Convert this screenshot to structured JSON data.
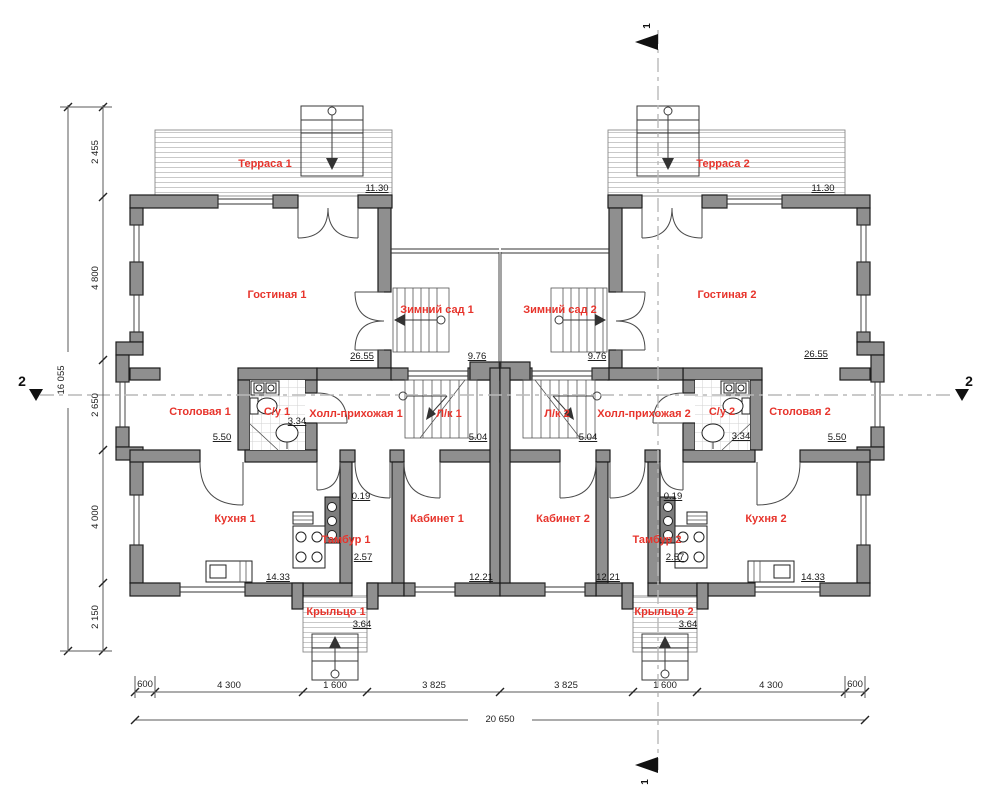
{
  "rooms": [
    {
      "id": "terrace-1",
      "label": "Терраса 1",
      "area": "11.30"
    },
    {
      "id": "terrace-2",
      "label": "Терраса 2",
      "area": "11.30"
    },
    {
      "id": "living-1",
      "label": "Гостиная 1",
      "area": "26.55"
    },
    {
      "id": "living-2",
      "label": "Гостиная 2",
      "area": "26.55"
    },
    {
      "id": "winter-garden-1",
      "label": "Зимний сад 1",
      "area": "9.76"
    },
    {
      "id": "winter-garden-2",
      "label": "Зимний сад 2",
      "area": "9.76"
    },
    {
      "id": "dining-1",
      "label": "Столовая 1",
      "area": "5.50"
    },
    {
      "id": "dining-2",
      "label": "Столовая 2",
      "area": "5.50"
    },
    {
      "id": "wc-1",
      "label": "С/у 1",
      "area": "3.34"
    },
    {
      "id": "wc-2",
      "label": "С/у 2",
      "area": "3.34"
    },
    {
      "id": "hall-1",
      "label": "Холл-прихожая 1"
    },
    {
      "id": "hall-2",
      "label": "Холл-прихожая 2"
    },
    {
      "id": "stair-1",
      "label": "Л/к 1",
      "area": "5.04"
    },
    {
      "id": "stair-2",
      "label": "Л/к 2",
      "area": "5.04"
    },
    {
      "id": "kitchen-1",
      "label": "Кухня 1",
      "area": "14.33"
    },
    {
      "id": "kitchen-2",
      "label": "Кухня 2",
      "area": "14.33"
    },
    {
      "id": "tambour-1",
      "label": "Тамбур 1",
      "area": "2.57"
    },
    {
      "id": "tambour-2",
      "label": "Тамбур 2",
      "area": "2.57"
    },
    {
      "id": "study-1",
      "label": "Кабинет 1",
      "area": "12.21"
    },
    {
      "id": "study-2",
      "label": "Кабинет 2",
      "area": "12.21"
    },
    {
      "id": "porch-1",
      "label": "Крыльцо 1",
      "area": "3.64"
    },
    {
      "id": "porch-2",
      "label": "Крыльцо 2",
      "area": "3.64"
    }
  ],
  "dimensions": {
    "vertical_total": "16 055",
    "vertical_chain": [
      "2 455",
      "4 800",
      "2 650",
      "4 000",
      "2 150"
    ],
    "horizontal_chain": [
      "600",
      "4 300",
      "1 600",
      "3 825",
      "3 825",
      "1 600",
      "4 300",
      "600"
    ],
    "horizontal_total": "20 650",
    "small": [
      "0.19",
      "0.19"
    ]
  },
  "section_markers": {
    "horizontal_axis": "2",
    "vertical_axis": "1"
  }
}
